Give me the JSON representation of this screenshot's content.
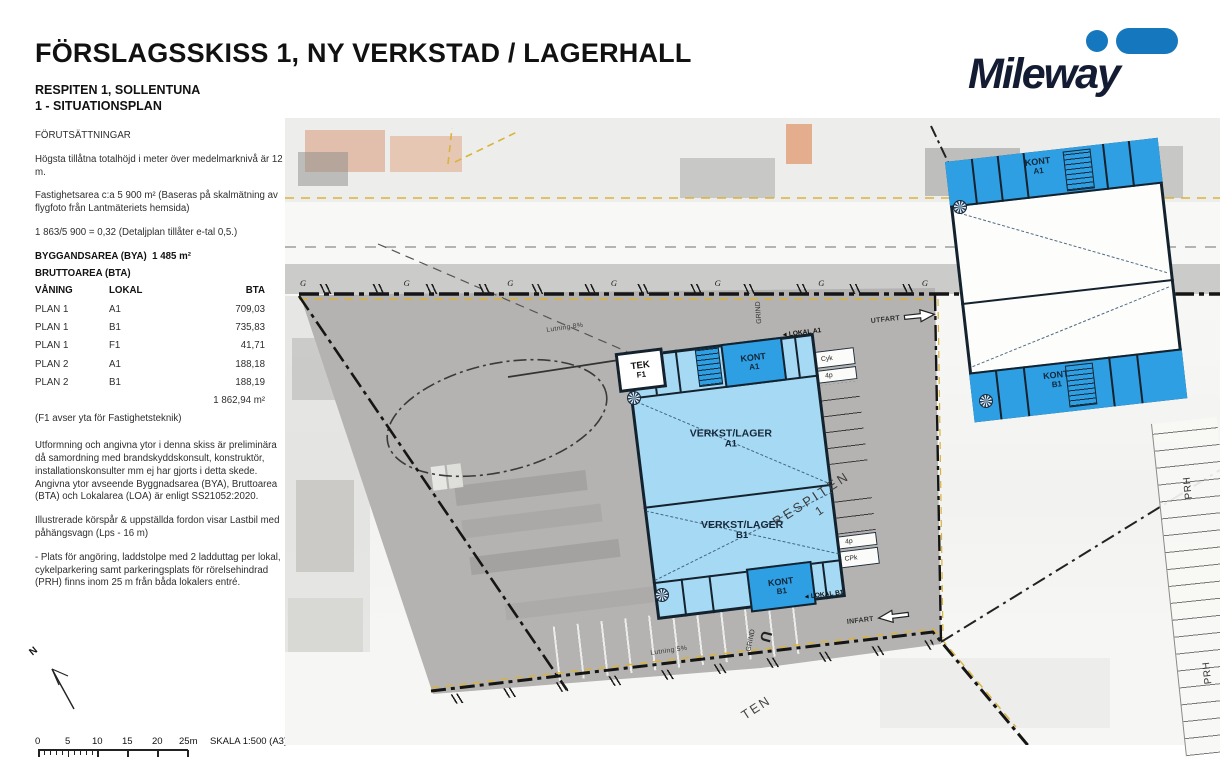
{
  "header": {
    "title": "FÖRSLAGSSKISS 1, NY VERKSTAD / LAGERHALL",
    "project": "RESPITEN 1, SOLLENTUNA",
    "sheet": "1 - SITUATIONSPLAN"
  },
  "logo": {
    "name": "Mileway"
  },
  "colors": {
    "logo_blue": "#1577be",
    "logo_dark": "#131c33",
    "building_light": "#a6d9f4",
    "building_dark": "#2f9fe3",
    "outline": "#14222e",
    "site_gray": "#b4b3b1",
    "boundary_yellow": "#d9b33c"
  },
  "notes": {
    "heading": "FÖRUTSÄTTNINGAR",
    "p1": "Högsta tillåtna totalhöjd i meter över medelmarknivå är 12 m.",
    "p2": "Fastighetsarea c:a 5 900 m² (Baseras på skalmätning av flygfoto från Lantmäteriets hemsida)",
    "p3": "1 863/5 900 = 0,32 (Detaljplan tillåter e-tal 0,5.)",
    "bya_label": "BYGGANDSAREA (BYA)",
    "bya_value": "1 485 m²",
    "bta_heading": "BRUTTOAREA (BTA)"
  },
  "area_table": {
    "columns": [
      "VÅNING",
      "LOKAL",
      "BTA"
    ],
    "rows": [
      [
        "PLAN 1",
        "A1",
        "709,03"
      ],
      [
        "PLAN 1",
        "B1",
        "735,83"
      ],
      [
        "PLAN 1",
        "F1",
        "41,71"
      ],
      [
        "PLAN 2",
        "A1",
        "188,18"
      ],
      [
        "PLAN 2",
        "B1",
        "188,19"
      ]
    ],
    "total": "1 862,94 m²",
    "footnote": "(F1 avser yta för Fastighetsteknik)"
  },
  "notes2": {
    "p1": "Utformning och angivna ytor i denna skiss är preliminära då samordning med brandskyddskonsult, konstruktör, installationskonsulter mm ej har gjorts i detta skede. Angivna ytor avseende Byggnadsarea (BYA), Bruttoarea (BTA) och Lokalarea (LOA) är enligt SS21052:2020.",
    "p2": "Illustrerade körspår & uppställda fordon visar Lastbil med påhängsvagn (Lps - 16 m)",
    "p3": "- Plats för angöring, laddstolpe med 2 ladduttag per lokal, cykelparkering samt parkeringsplats för rörelsehindrad (PRH) finns inom 25 m från båda lokalers entré."
  },
  "plan": {
    "street": "RESPITEN",
    "street_no": "1",
    "street_partial": "TEN",
    "slope_top": "Lutning 8%",
    "slope_bottom": "Lutning 5%",
    "tek": "TEK",
    "tek_unit": "F1",
    "kont": "KONT",
    "unit_a1": "A1",
    "unit_b1": "B1",
    "hall": "VERKST/LAGER",
    "lokal_a1": "LOKAL A1",
    "lokal_b1": "LOKAL B1",
    "utfart": "UTFART",
    "infart": "INFART",
    "prh": "PRH",
    "grind": "GRIND",
    "cyk": "Cyk",
    "els": "ELS",
    "p4": "4p",
    "cpk": "CPk",
    "u_turn": "U",
    "g_mark": "G",
    "entresol_caption": "PLANUTSNITT ENTRESOLPLAN"
  },
  "scalebar": {
    "ticks": [
      "0",
      "5",
      "10",
      "15",
      "20",
      "25m"
    ],
    "label": "SKALA 1:500 (A3)"
  },
  "north_label": "N"
}
